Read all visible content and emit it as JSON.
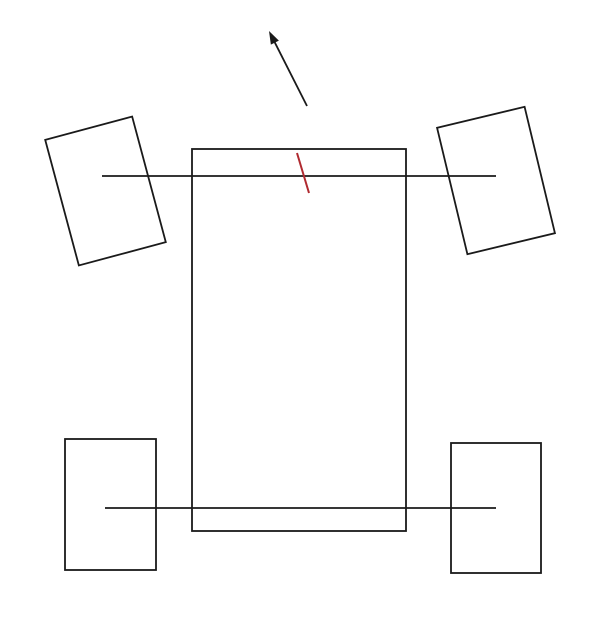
{
  "canvas": {
    "width": 600,
    "height": 624,
    "background_color": "#ffffff"
  },
  "diagram": {
    "description": "top-down schematic of a four-wheeled vehicle with front wheels steered left, a heading arrow, and a red steering-direction marker",
    "stroke_color": "#1a1a1a",
    "accent_color": "#b02a30",
    "body": {
      "x": 192,
      "y": 149,
      "width": 214,
      "height": 382
    },
    "front_axle": {
      "x1": 102,
      "y1": 176,
      "x2": 496,
      "y2": 176
    },
    "rear_axle": {
      "x1": 105,
      "y1": 508,
      "x2": 496,
      "y2": 508
    },
    "wheels": [
      {
        "name": "front-left-wheel",
        "cx": 105.5,
        "cy": 191,
        "width": 90,
        "height": 130,
        "angle_deg": -15
      },
      {
        "name": "front-right-wheel",
        "cx": 496,
        "cy": 180.5,
        "width": 90,
        "height": 130,
        "angle_deg": -13.5
      },
      {
        "name": "rear-left-wheel",
        "cx": 110.5,
        "cy": 504.5,
        "width": 91,
        "height": 131,
        "angle_deg": 0
      },
      {
        "name": "rear-right-wheel",
        "cx": 496,
        "cy": 508,
        "width": 90,
        "height": 130,
        "angle_deg": 0
      }
    ],
    "heading_arrow": {
      "x1": 307,
      "y1": 106,
      "x2": 269,
      "y2": 31
    },
    "steering_marker": {
      "x1": 297,
      "y1": 153,
      "x2": 309,
      "y2": 193
    }
  }
}
